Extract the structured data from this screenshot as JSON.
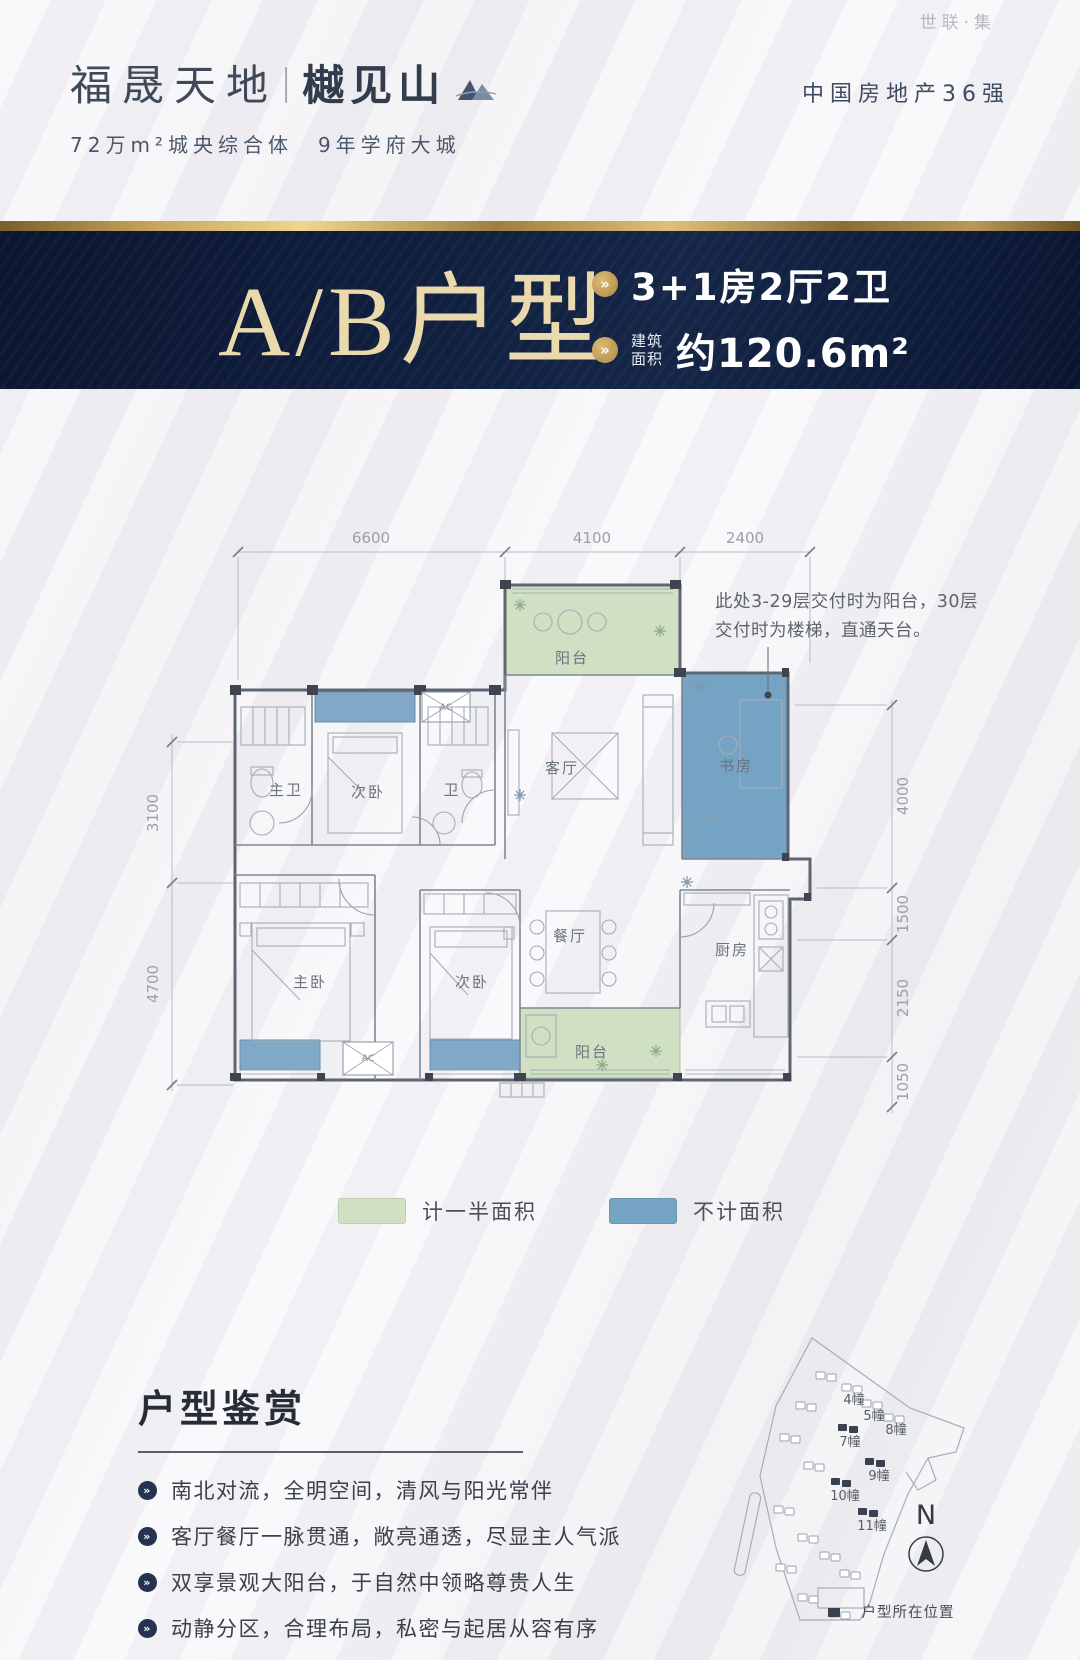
{
  "watermark": "世联·集",
  "icons": {
    "chevron": "»"
  },
  "colors": {
    "accent_gold": "#c9a45c",
    "banner_navy": "#101d3a",
    "legend_green": "#cfe0c3",
    "legend_blue": "#74a3c4"
  },
  "header": {
    "logo_primary": "福晟天地",
    "logo_divider": "|",
    "logo_secondary": "樾见山",
    "tagline": "72万m²城央综合体　9年学府大城",
    "ranking": "中国房地产36强"
  },
  "banner": {
    "title": "A/B户型",
    "spec": "3+1房2厅2卫",
    "area_label_line1": "建筑",
    "area_label_line2": "面积",
    "area_value": "约120.6m²"
  },
  "floorplan": {
    "dims_top": [
      "6600",
      "4100",
      "2400"
    ],
    "dims_left": [
      "3100",
      "4700"
    ],
    "dims_right": [
      "4000",
      "1500",
      "2150",
      "1050"
    ],
    "note_line1": "此处3-29层交付时为阳台，30层",
    "note_line2": "交付时为楼梯，直通天台。",
    "rooms": {
      "balcony_top": "阳台",
      "living": "客厅",
      "study": "书房",
      "master_bath": "主卫",
      "bedroom2": "次卧",
      "bath": "卫",
      "master_bedroom": "主卧",
      "bedroom3": "次卧",
      "dining": "餐厅",
      "kitchen": "厨房",
      "balcony_bottom": "阳台",
      "ac": "AC"
    },
    "legend": [
      {
        "label": "计一半面积",
        "color": "#cfe0c3"
      },
      {
        "label": "不计面积",
        "color": "#74a3c4"
      }
    ]
  },
  "features": {
    "title": "户型鉴赏",
    "items": [
      "南北对流，全明空间，清风与阳光常伴",
      "客厅餐厅一脉贯通，敞亮通透，尽显主人气派",
      "双享景观大阳台，于自然中领略尊贵人生",
      "动静分区，合理布局，私密与起居从容有序",
      "双卫生间设计，细节周到考量，尊享舒适生活"
    ]
  },
  "sitemap": {
    "buildings": [
      "4幢",
      "5幢",
      "8幢",
      "7幢",
      "9幢",
      "10幢",
      "11幢"
    ],
    "compass": "N",
    "caption": "户型所在位置"
  }
}
